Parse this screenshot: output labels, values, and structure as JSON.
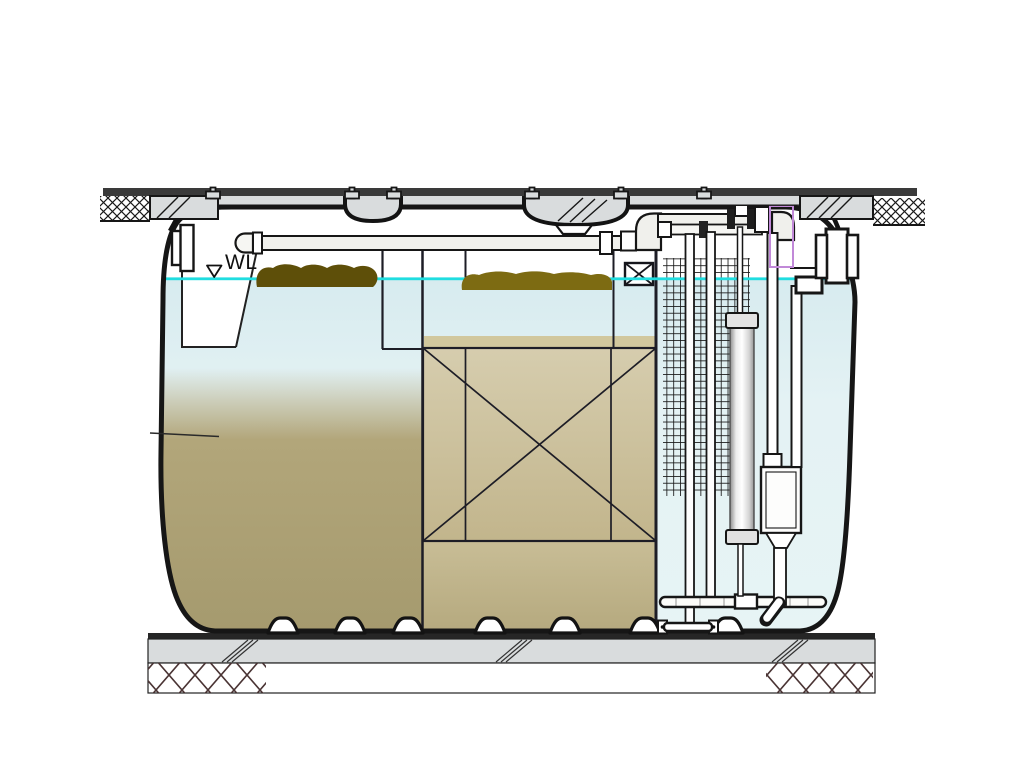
{
  "labels": {
    "water_level": "WL"
  },
  "colors": {
    "outline": "#161616",
    "slab": "#d9dcdd",
    "slab_edge": "#3a3a3a",
    "water": "#e0eff2",
    "waterline": "#1fdde0",
    "sludge": "#b0a57d",
    "media": "#d2c8a5",
    "scum_dark": "#5e4f09",
    "scum_light": "#7d6b12",
    "purple": "#c189d8",
    "foundation_hatch": "#4a3434",
    "pipe_fill": "#f0f0ec"
  }
}
